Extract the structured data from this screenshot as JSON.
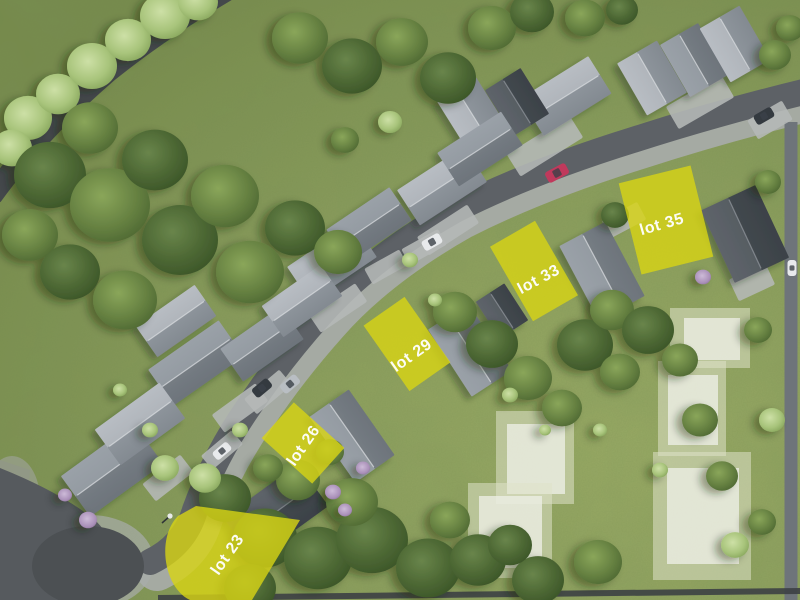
{
  "view": {
    "type": "aerial-site-plan",
    "width": 800,
    "height": 600
  },
  "lots": {
    "highlight_color": "#d8d414",
    "label_color": "#ffffff",
    "items": [
      {
        "id": "lot-23",
        "label": "lot 23"
      },
      {
        "id": "lot-26",
        "label": "lot 26"
      },
      {
        "id": "lot-29",
        "label": "lot 29"
      },
      {
        "id": "lot-33",
        "label": "lot 33"
      },
      {
        "id": "lot-35",
        "label": "lot 35"
      }
    ]
  },
  "future_lots": {
    "count": 5,
    "fill": "#e7e9d6"
  },
  "palette": {
    "grass": "#86995b",
    "tree_dark": "#4a6331",
    "tree_light": "#bcd193",
    "road_asphalt": "#5d6166",
    "road_minor": "#44484b",
    "sidewalk": "#a8acab",
    "roof_light": "#aab0b6",
    "roof_medium": "#868d94",
    "roof_dark": "#4d5359",
    "car_red": "#c0395c",
    "car_white": "#e8eaec",
    "car_dark": "#343a40",
    "car_silver": "#b9bec3"
  }
}
